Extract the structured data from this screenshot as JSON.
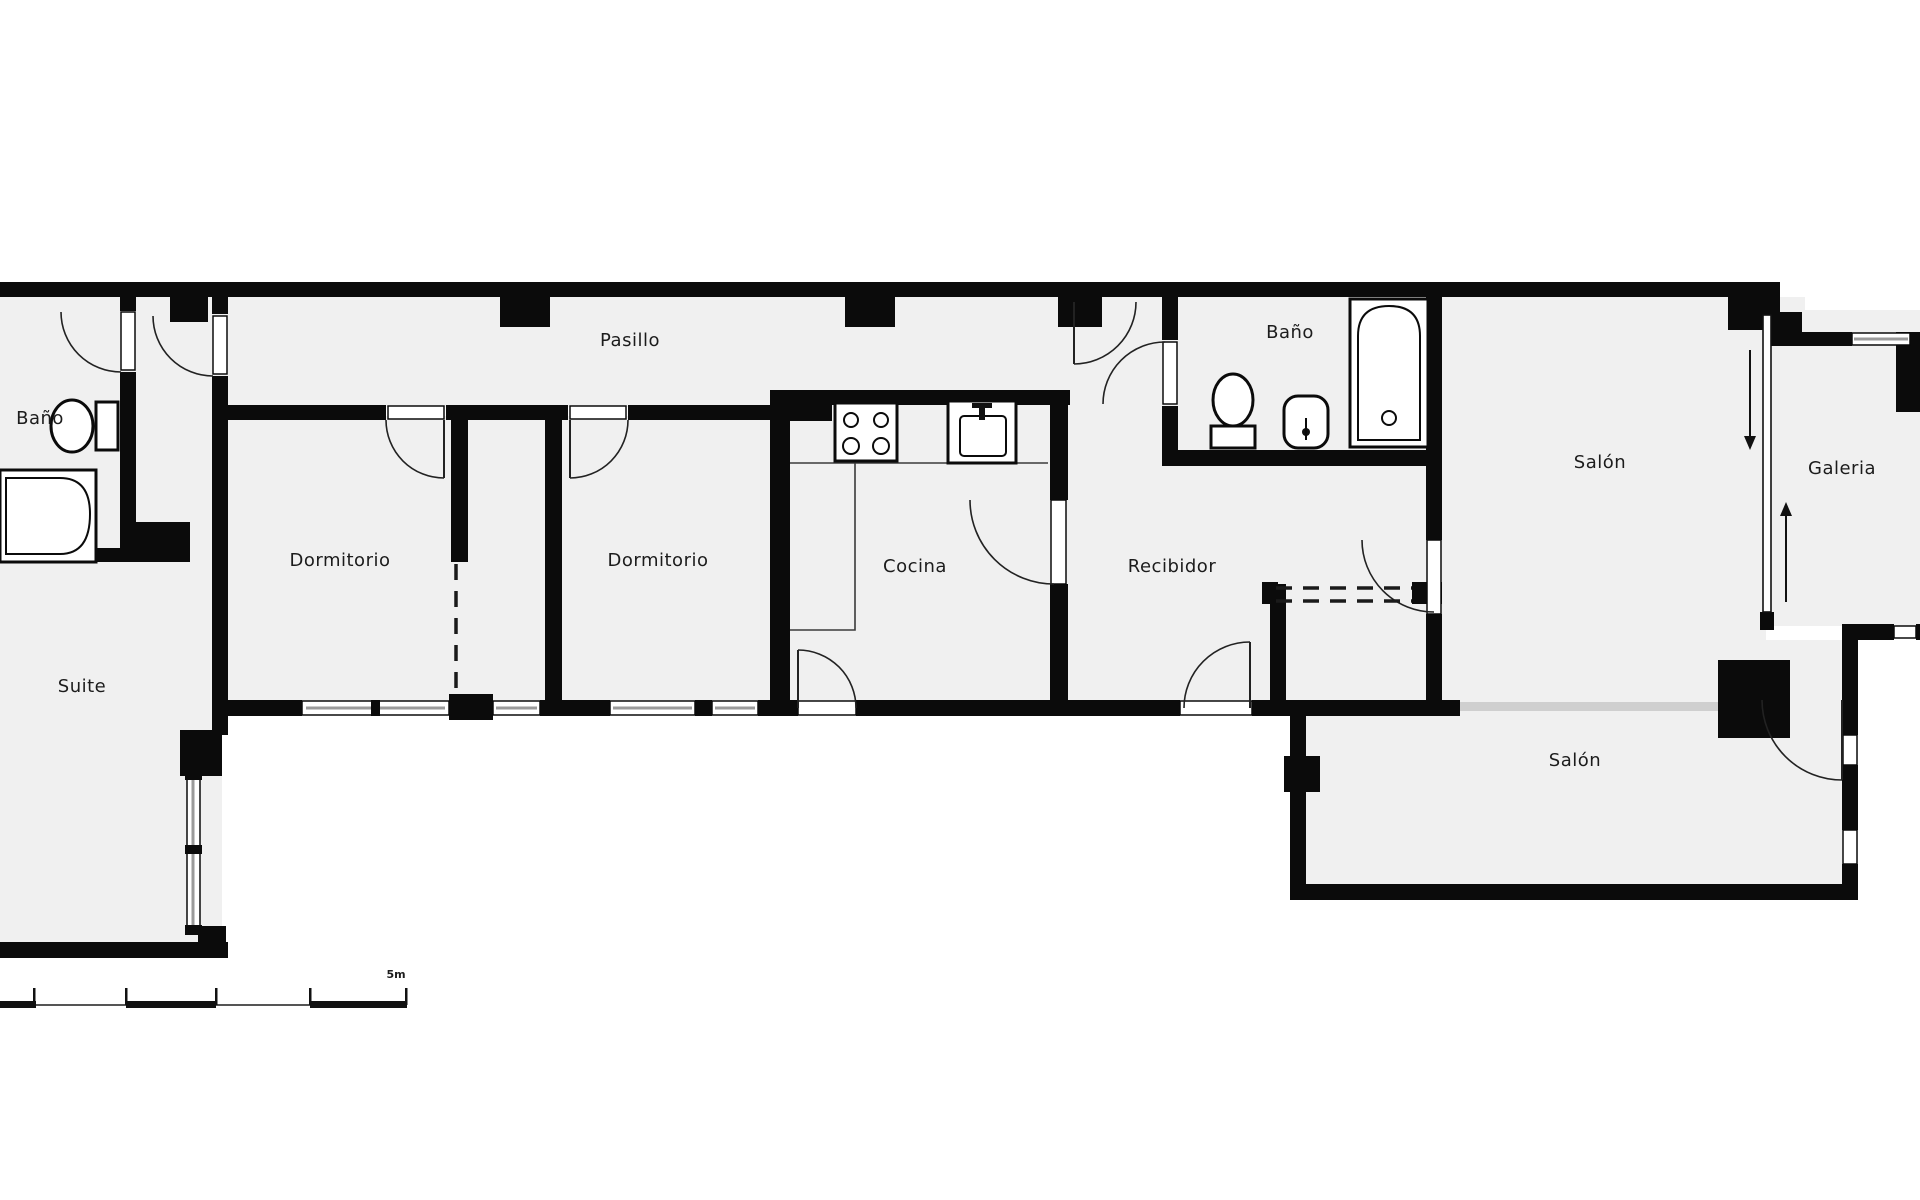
{
  "floorplan": {
    "title": "Apartment floor plan",
    "rooms": [
      {
        "id": "pasillo",
        "label": "Pasillo"
      },
      {
        "id": "bano-left",
        "label": "Baño"
      },
      {
        "id": "suite",
        "label": "Suite"
      },
      {
        "id": "dormitorio-1",
        "label": "Dormitorio"
      },
      {
        "id": "dormitorio-2",
        "label": "Dormitorio"
      },
      {
        "id": "cocina",
        "label": "Cocina"
      },
      {
        "id": "recibidor",
        "label": "Recibidor"
      },
      {
        "id": "bano-right",
        "label": "Baño"
      },
      {
        "id": "salon-north",
        "label": "Salón"
      },
      {
        "id": "galeria",
        "label": "Galeria"
      },
      {
        "id": "salon-south",
        "label": "Salón"
      }
    ],
    "scale_bar": {
      "label": "5m",
      "meters": 5
    },
    "fixtures": [
      "toilet-icon",
      "bathtub-icon",
      "stove-icon",
      "kitchen-sink-icon",
      "toilet-icon",
      "bidet-icon",
      "bathtub-icon",
      "sliding-door-icon"
    ],
    "colors": {
      "wall": "#0b0b0b",
      "floor": "#f0f0f0",
      "exterior": "#ffffff",
      "glazing": "#9a9a9a",
      "floor_opening": "#cfcfcf",
      "text": "#1c1c1c"
    }
  }
}
